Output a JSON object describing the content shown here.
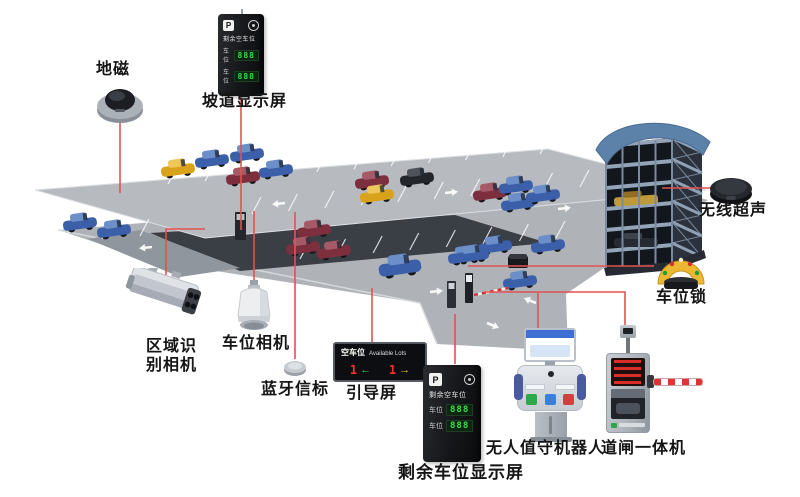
{
  "colors": {
    "connector_line": "#e25252",
    "deck_upper": "#b7bbc0",
    "deck_lower": "#afb3b8",
    "led_green": "#38e04a",
    "led_red": "#ff2e2e",
    "arrow_green": "#2ed43a",
    "arrow_yellow": "#f5c51d",
    "lock_yellow": "#ecb832",
    "label_text": "#151515"
  },
  "devices": {
    "geomagnetic": {
      "label": "地磁"
    },
    "ramp_display": {
      "label": "坡道显示屏"
    },
    "area_recognition_camera": {
      "label_line1": "区域识",
      "label_line2": "别相机"
    },
    "space_camera": {
      "label": "车位相机"
    },
    "bluetooth_beacon": {
      "label": "蓝牙信标"
    },
    "guidance_screen": {
      "label": "引导屏"
    },
    "wireless_ultrasonic": {
      "label": "无线超声"
    },
    "parking_lock": {
      "label": "车位锁"
    },
    "remaining_display": {
      "label": "剩余车位显示屏"
    },
    "unattended_robot": {
      "label": "无人值守机器人"
    },
    "barrier_gate": {
      "label": "道闸一体机"
    }
  },
  "guidance_panel": {
    "title_cn": "空车位",
    "title_en": "Available Lots",
    "left_count": "1",
    "left_arrow": "←",
    "right_count": "1",
    "right_arrow": "→"
  },
  "pillar_panel": {
    "logo": "P",
    "title": "剩余空车位",
    "rows": [
      {
        "name": "车位",
        "value": "888"
      },
      {
        "name": "车位",
        "value": "888"
      }
    ]
  }
}
